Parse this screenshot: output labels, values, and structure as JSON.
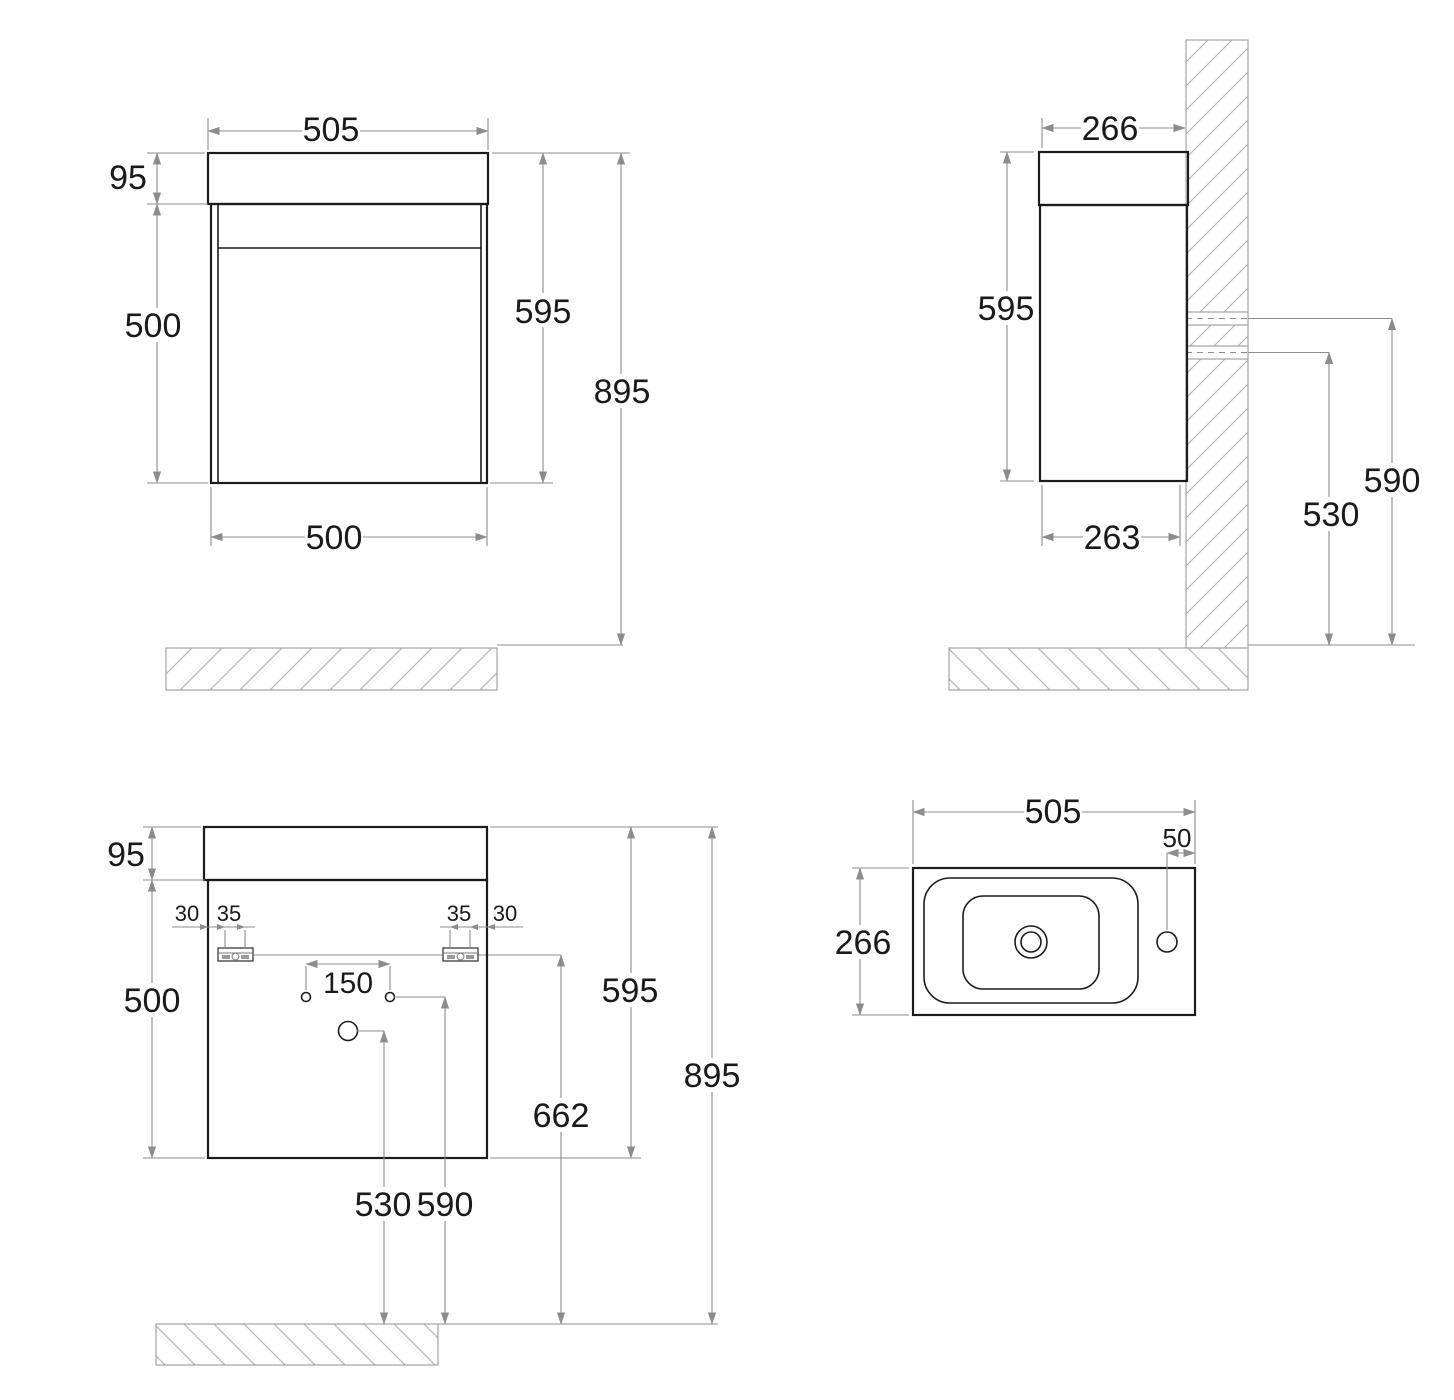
{
  "colors": {
    "object_line": "#1c1c1c",
    "dimension_line": "#8c8c8c",
    "hatch_line": "#b5b5b5",
    "background": "#ffffff"
  },
  "views": {
    "front": {
      "dims": {
        "basin_width": "505",
        "basin_height": "95",
        "cabinet_height": "500",
        "unit_height": "595",
        "overall_height": "895",
        "cabinet_width": "500"
      }
    },
    "side": {
      "dims": {
        "depth": "266",
        "unit_height": "595",
        "cabinet_depth": "263",
        "upper_fixing_height": "590",
        "lower_fixing_height": "530"
      }
    },
    "rear": {
      "dims": {
        "basin_height": "95",
        "cabinet_height": "500",
        "edge_offset_left": "30",
        "bracket_slot_left": "35",
        "bracket_slot_right": "35",
        "edge_offset_right": "30",
        "tap_hole_spacing": "150",
        "unit_height": "595",
        "rail_height": "662",
        "overall_height": "895",
        "drain_height": "530",
        "fixing_height": "590"
      }
    },
    "top": {
      "dims": {
        "basin_width": "505",
        "tap_hole_edge_offset": "50",
        "basin_depth": "266"
      }
    }
  }
}
